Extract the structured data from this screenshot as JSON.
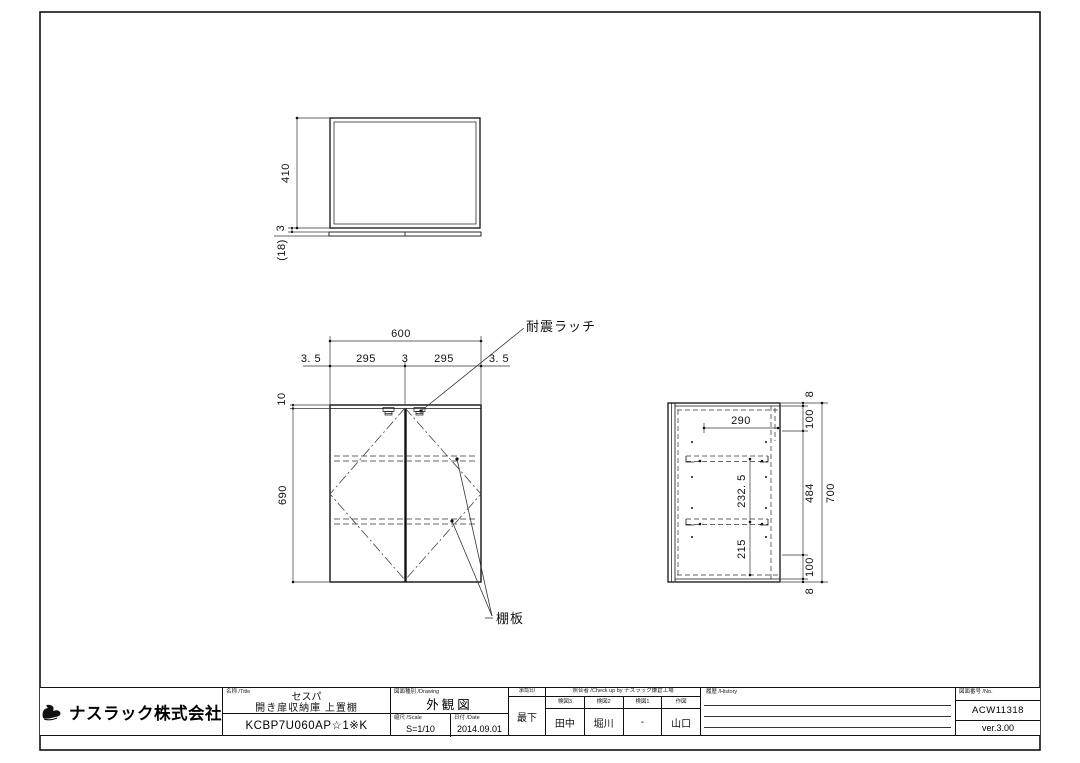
{
  "drawing": {
    "top_view": {
      "depth": "410",
      "gap": "3",
      "door_thickness": "(18)"
    },
    "front_view": {
      "width": "600",
      "edge_gap_left": "3. 5",
      "door_left": "295",
      "center_gap": "3",
      "door_right": "295",
      "edge_gap_right": "3. 5",
      "top_rail": "10",
      "height": "690",
      "latch_label": "耐震ラッチ",
      "shelf_label": "棚板"
    },
    "side_view": {
      "shelf_depth": "290",
      "shelf_spacing": "232. 5",
      "bottom_spacing": "215",
      "top_thickness": "8",
      "top_offset": "100",
      "mid_span": "484",
      "total_height": "700",
      "bottom_offset": "100",
      "bottom_thickness": "8"
    }
  },
  "title_block": {
    "company": "ナスラック株式会社",
    "name_label": "名称 /Title",
    "series": "セスパ",
    "product": "開き扉収納庫 上置棚",
    "model": "KCBP7U060AP☆1※K",
    "drawing_type_label": "図面種別 /Drawing",
    "drawing_type": "外観図",
    "scale_label": "縮尺 /Scale",
    "scale": "S=1/10",
    "date_label": "日付 /Date",
    "date": "2014.09.01",
    "approval_label": "承認印",
    "approval": "最下",
    "checkup_label": "照合者 /Check up by ナスラック鎌倉工場",
    "checkers": {
      "cols": [
        {
          "role": "検図3",
          "name": "田中"
        },
        {
          "role": "検図2",
          "name": "堀川"
        },
        {
          "role": "検図1",
          "name": "-"
        },
        {
          "role": "作図",
          "name": "山口"
        }
      ]
    },
    "history_label": "履歴 /History",
    "number_label": "図面番号 /No.",
    "number": "ACW11318",
    "version": "ver.3.00"
  }
}
